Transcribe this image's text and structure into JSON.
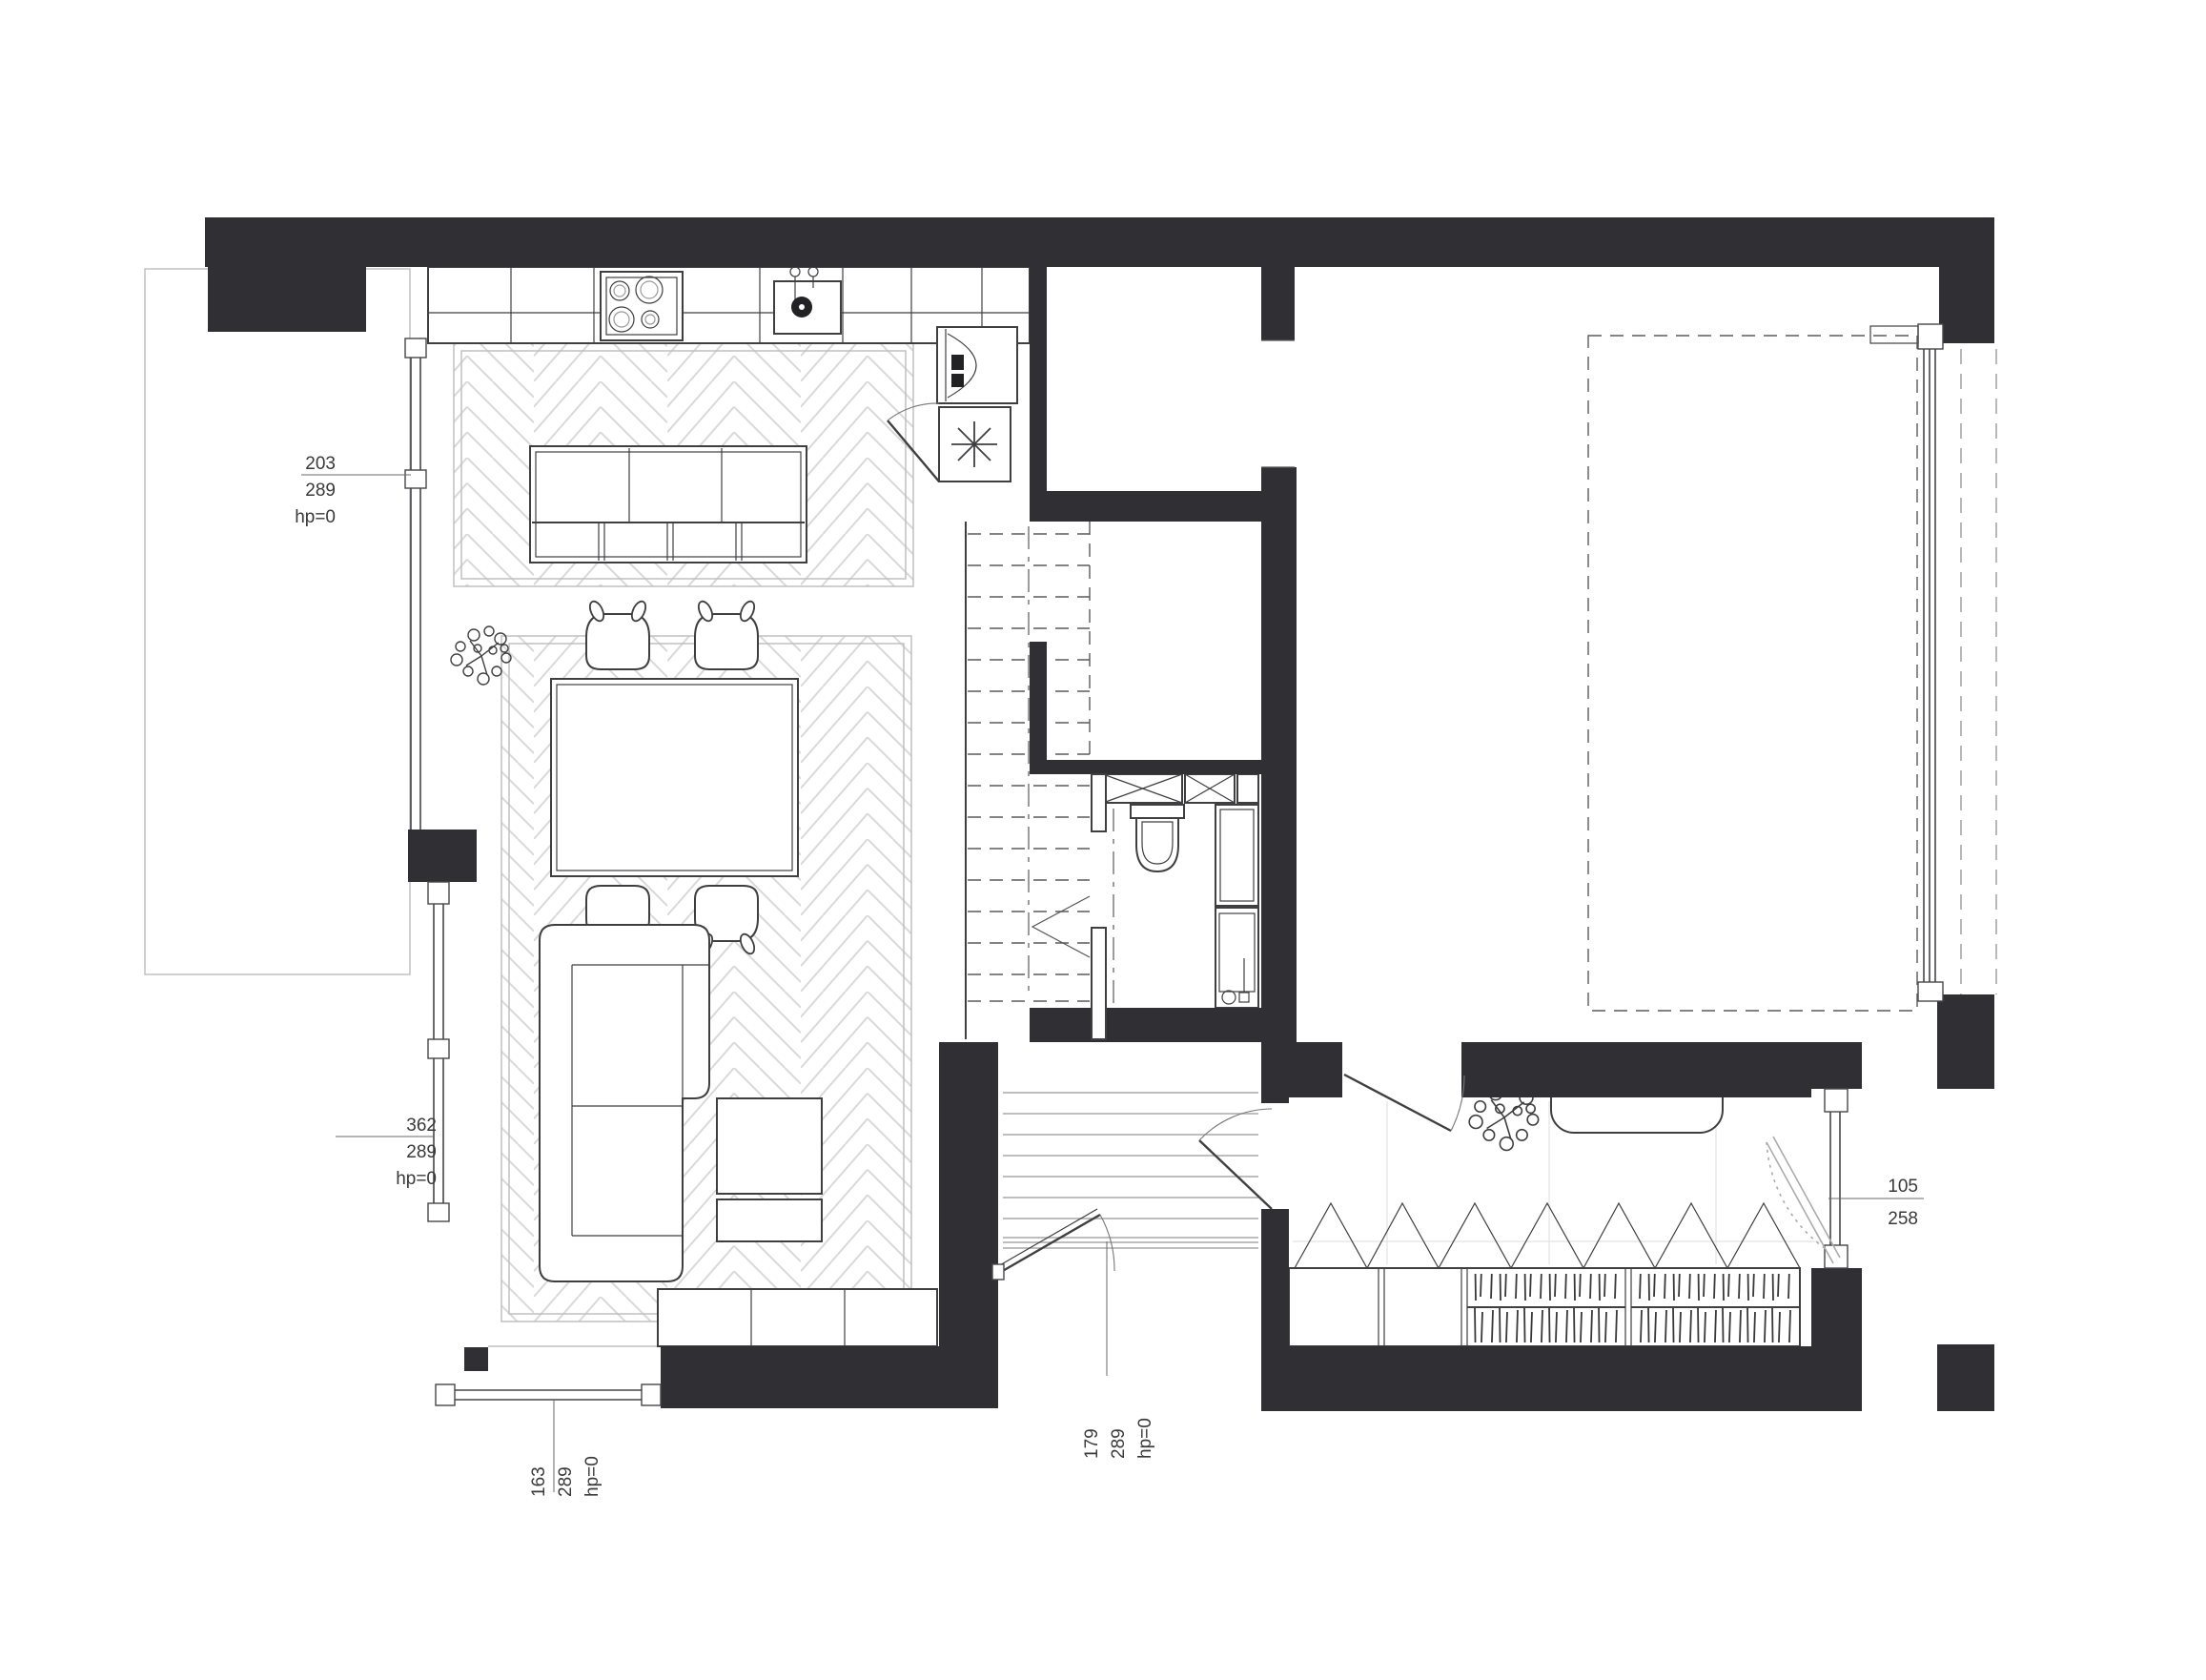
{
  "plan": {
    "type": "architectural-floor-plan",
    "colors": {
      "wall": "#303034",
      "outline": "#3f3f42",
      "floor_pattern": "#d9d9db",
      "dimension_text": "#39393b"
    },
    "dimensions": {
      "kitchen_window": {
        "line1": "203",
        "line2": "289",
        "line3": "hp=0"
      },
      "living_window": {
        "line1": "362",
        "line2": "289",
        "line3": "hp=0"
      },
      "south_window": {
        "line1": "163",
        "line2": "289",
        "line3": "hp=0"
      },
      "entrance_door": {
        "line1": "179",
        "line2": "289",
        "line3": "hp=0"
      },
      "dressing_window": {
        "line1": "105",
        "line2": "258"
      }
    }
  }
}
